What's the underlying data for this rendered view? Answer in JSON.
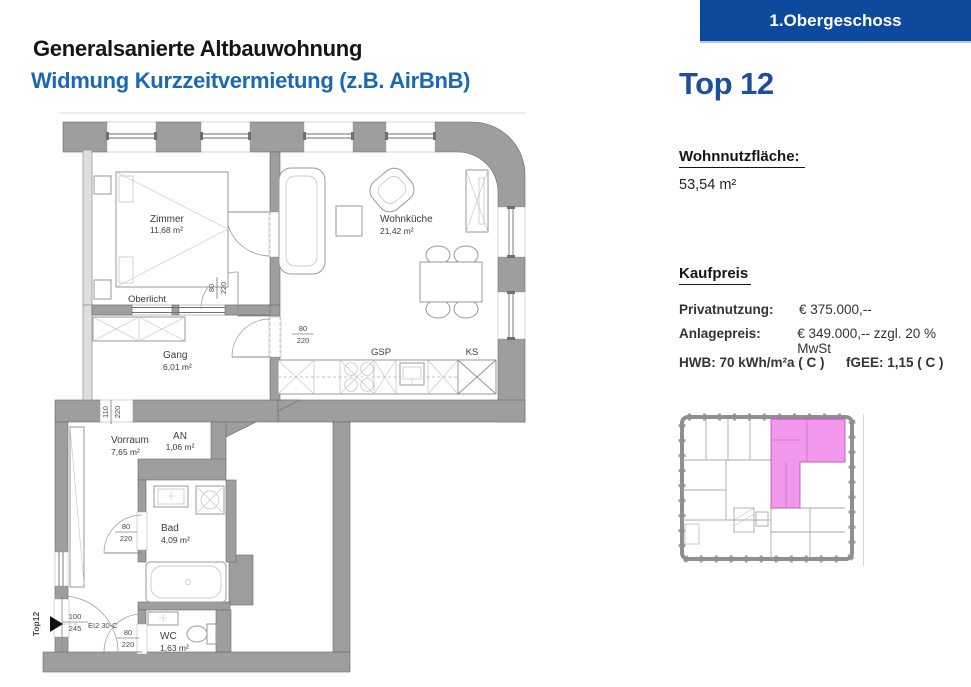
{
  "banner": {
    "label": "1.Obergeschoss",
    "bg_color": "#0d4a9e"
  },
  "header": {
    "title": "Generalsanierte Altbauwohnung",
    "subtitle": "Widmung Kurzzeitvermietung (z.B. AirBnB)",
    "subtitle_color": "#1b68b3"
  },
  "unit": {
    "name": "Top 12",
    "color": "#1d4f9f"
  },
  "living_area": {
    "label": "Wohnnutzfläche:",
    "value": "53,54 m²"
  },
  "price": {
    "heading": "Kaufpreis",
    "rows": [
      {
        "label": "Privatnutzung:",
        "value": "€ 375.000,--"
      },
      {
        "label": "Anlagepreis:",
        "value": "€ 349.000,-- zzgl. 20 % MwSt"
      }
    ],
    "hwb": "HWB: 70 kWh/m²a ( C )",
    "fgee": "fGEE: 1,15 ( C )"
  },
  "plan": {
    "rooms": {
      "zimmer": {
        "name": "Zimmer",
        "area": "11,68 m²"
      },
      "wohnkueche": {
        "name": "Wohnküche",
        "area": "21,42 m²"
      },
      "gang": {
        "name": "Gang",
        "area": "6,01 m²"
      },
      "vorraum": {
        "name": "Vorraum",
        "area": "7,65 m²"
      },
      "an": {
        "name": "AN",
        "area": "1,06 m²"
      },
      "bad": {
        "name": "Bad",
        "area": "4,09 m²"
      },
      "wc": {
        "name": "WC",
        "area": "1,63 m²"
      }
    },
    "labels": {
      "oberlicht": "Oberlicht",
      "gsp": "GSP",
      "ks": "KS",
      "entry": "Top12",
      "fire_door": "EI2 30-C"
    },
    "dims": {
      "door_zimmer": {
        "w": "80",
        "h": "220"
      },
      "door_wohnkueche": {
        "w": "80",
        "h": "220"
      },
      "door_vorraum": {
        "w": "110",
        "h": "220"
      },
      "door_bad": {
        "w": "80",
        "h": "220"
      },
      "door_wc": {
        "w": "80",
        "h": "220"
      },
      "door_entry": {
        "w": "100",
        "h": "245"
      }
    },
    "colors": {
      "wall": "#9e9e9e",
      "site_highlight": "#ef86e9"
    }
  }
}
